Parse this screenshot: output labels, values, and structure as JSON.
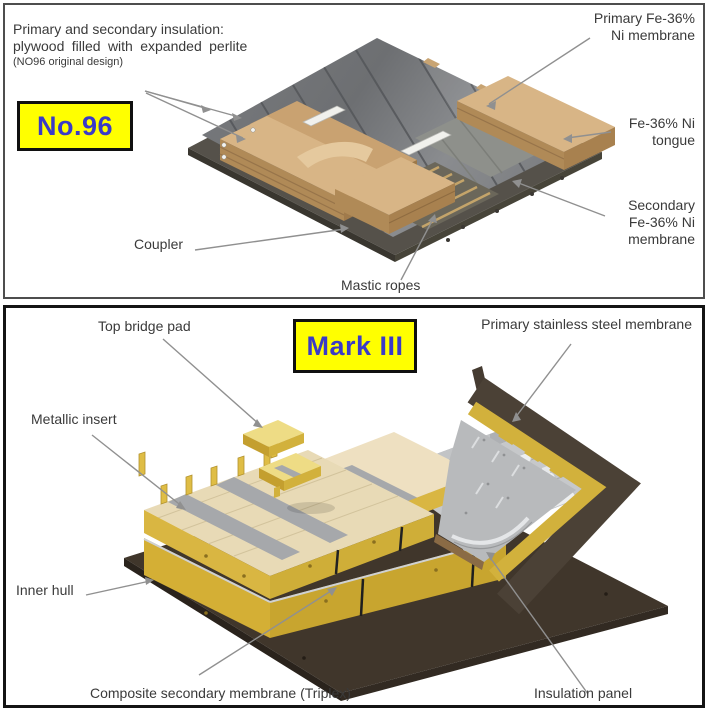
{
  "no96_panel": {
    "badge": "No.96",
    "labels": {
      "insulation": {
        "line1": "Primary and secondary insulation:",
        "line2": "plywood filled with expanded perlite",
        "line3": "(NO96 original design)"
      },
      "primary_membrane": {
        "line1": "Primary Fe-36%",
        "line2": "Ni membrane"
      },
      "tongue": {
        "line1": "Fe-36% Ni",
        "line2": "tongue"
      },
      "secondary_membrane": {
        "line1": "Secondary",
        "line2": "Fe-36% Ni",
        "line3": "membrane"
      },
      "coupler": "Coupler",
      "mastic_ropes": "Mastic ropes"
    }
  },
  "mark3_panel": {
    "badge": "Mark III",
    "labels": {
      "top_bridge_pad": "Top bridge pad",
      "primary_membrane": "Primary stainless steel membrane",
      "metallic_insert": "Metallic insert",
      "inner_hull": "Inner hull",
      "composite_secondary_membrane": "Composite secondary membrane (Triplex)",
      "insulation_panel": "Insulation panel"
    }
  },
  "colors": {
    "badge_background": "#FFFF00",
    "badge_text": "#3A3AC8",
    "label_text": "#3A3A3A",
    "leader_line": "#909090",
    "wood": "#D8B586",
    "membrane_gray": "#6E7073",
    "foam_yellow": "#D9B642",
    "inner_hull_brown": "#40362B"
  }
}
